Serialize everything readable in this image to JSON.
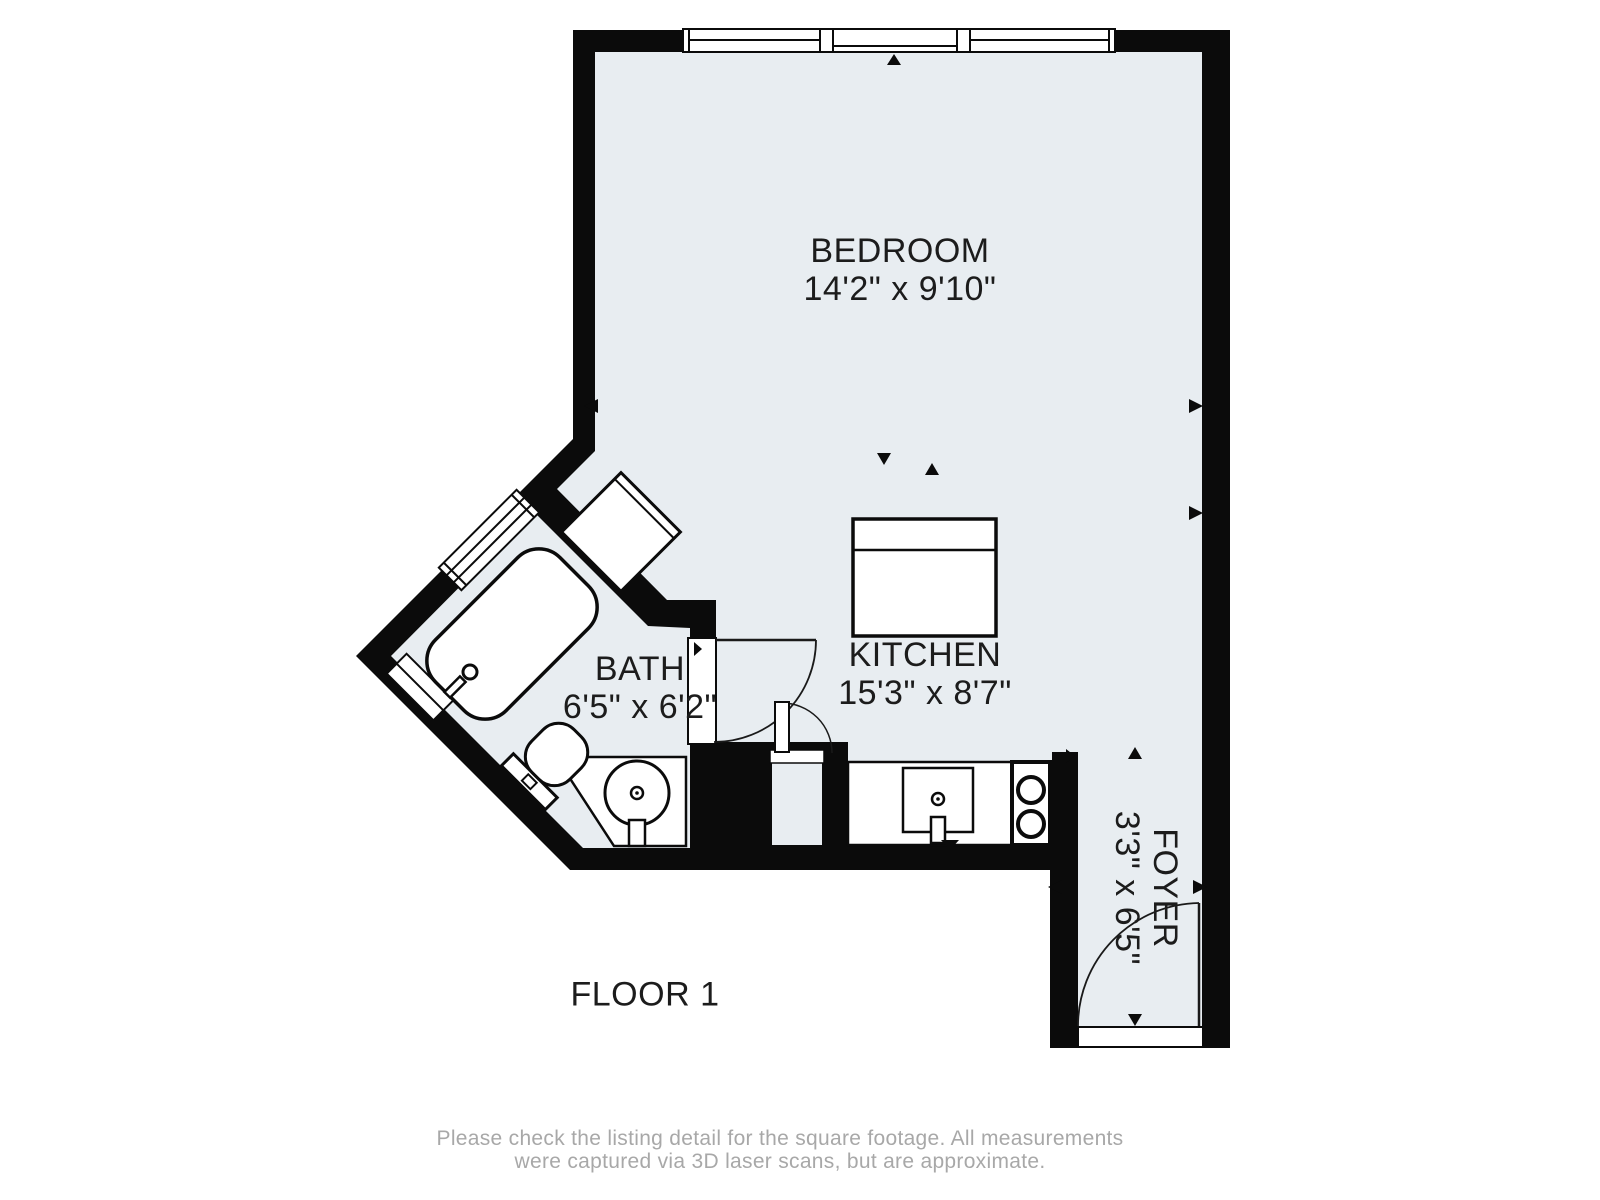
{
  "floorplan": {
    "floor_label": "FLOOR 1",
    "rooms": [
      {
        "name": "BEDROOM",
        "dimensions": "14'2\" x 9'10\""
      },
      {
        "name": "KITCHEN",
        "dimensions": "15'3\" x 8'7\""
      },
      {
        "name": "BATH",
        "dimensions": "6'5\" x 6'2\""
      },
      {
        "name": "FOYER",
        "dimensions": "3'3\" x 6'5\""
      }
    ],
    "disclaimer": {
      "line1": "Please check the listing detail for the square footage. All measurements",
      "line2": "were captured via 3D laser scans, but are approximate."
    },
    "colors": {
      "wall": "#0b0b0b",
      "floor_fill": "#e8edf1",
      "fixture_fill": "#ffffff",
      "label_text": "#1c1c1c",
      "disclaimer_text": "#a8a8a8"
    }
  }
}
